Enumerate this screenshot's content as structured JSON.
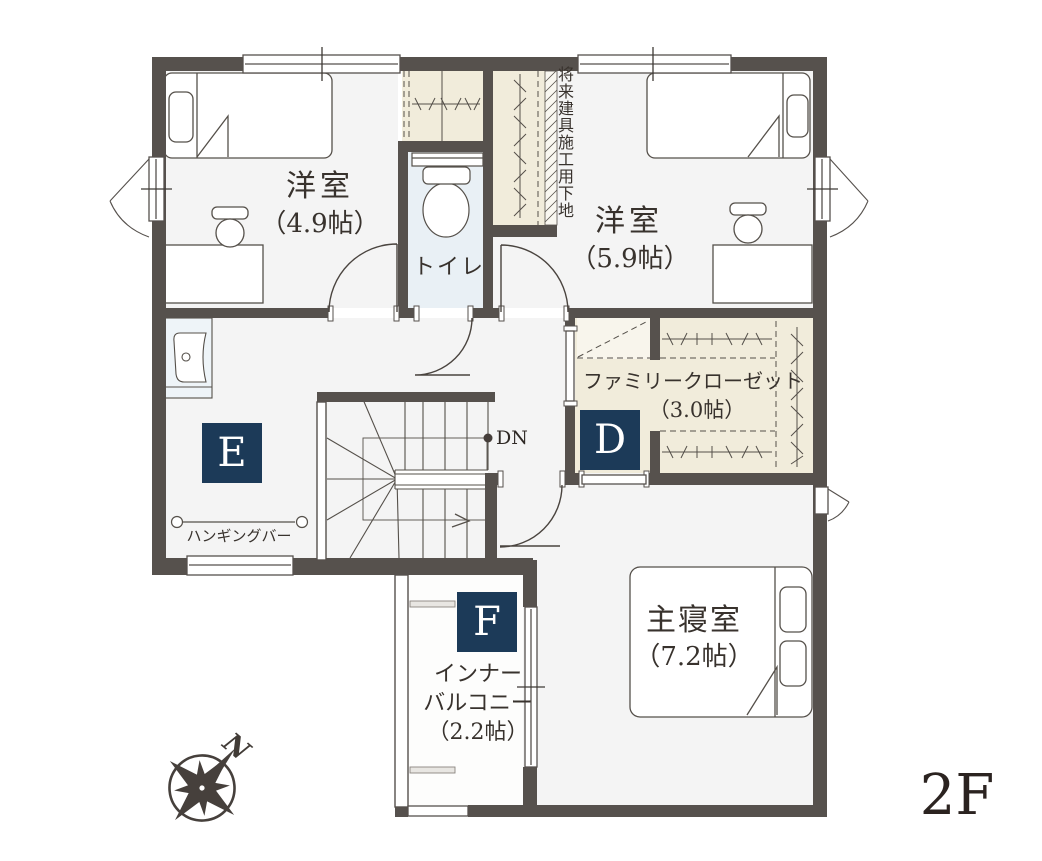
{
  "floor_plan": {
    "floor_label": "2F",
    "compass": {
      "north_label": "N"
    },
    "rooms": {
      "western_room_1": {
        "name": "洋室",
        "size": "（4.9帖）"
      },
      "western_room_2": {
        "name": "洋室",
        "size": "（5.9帖）"
      },
      "toilet": {
        "name": "トイレ"
      },
      "family_closet": {
        "name": "ファミリークローゼット",
        "size": "（3.0帖）",
        "badge": "D"
      },
      "hall": {
        "badge": "E",
        "hanging_bar_label": "ハンギングバー"
      },
      "master_bedroom": {
        "name": "主寝室",
        "size": "（7.2帖）"
      },
      "inner_balcony": {
        "name_line_1": "インナー",
        "name_line_2": "バルコニー",
        "size": "（2.2帖）",
        "badge": "F"
      }
    },
    "stairs": {
      "down_label": "DN"
    },
    "notes": {
      "future_fitting": "将来建具施工用下地"
    },
    "colors": {
      "wall": "#56514d",
      "floor": "#f4f4f4",
      "closet_fill": "#f1ecdb",
      "toilet_floor": "#e9f0f5",
      "badge": "#1c3a58"
    }
  }
}
